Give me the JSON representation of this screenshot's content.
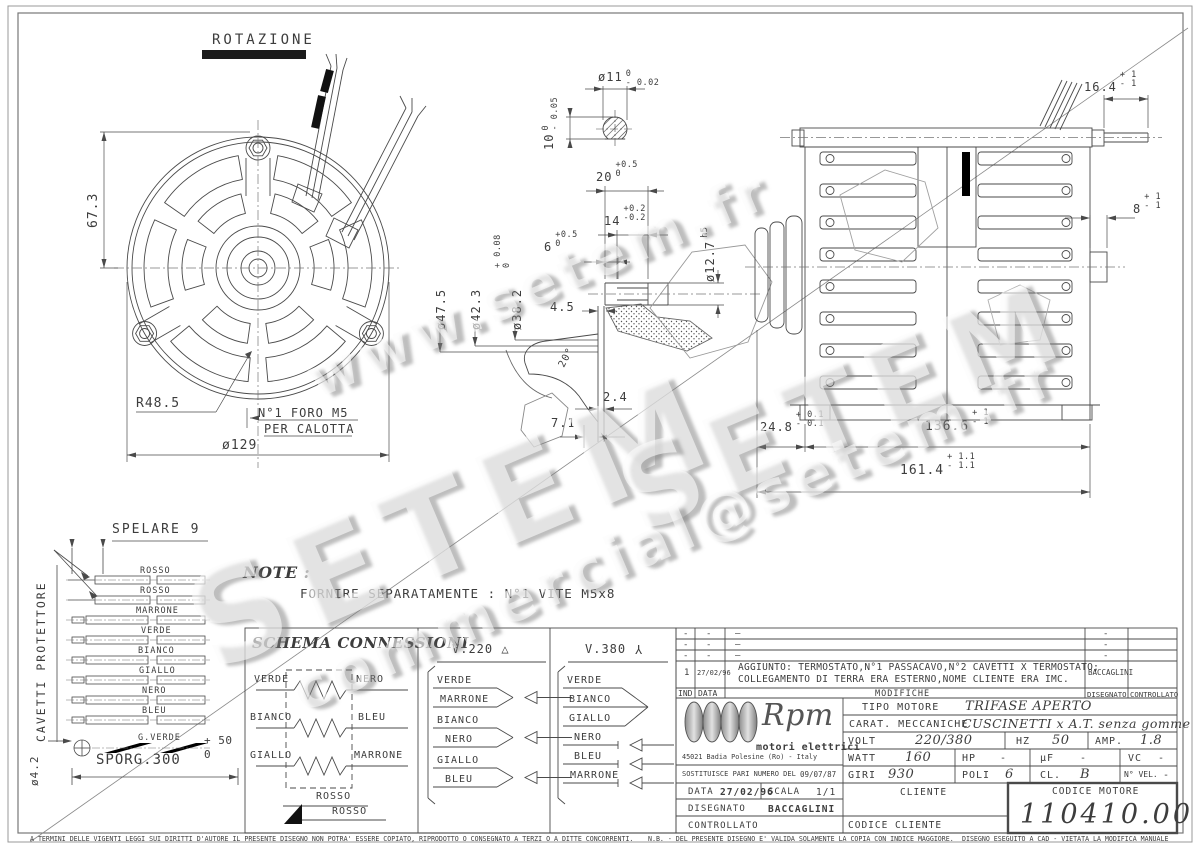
{
  "sheet": {
    "rotazione": "ROTAZIONE",
    "note_title": "NOTE :",
    "note_body": "FORNIRE SEPARATAMENTE : N°1 VITE M5x8",
    "watermark": {
      "w1": "www.setem.fr",
      "w2": "SETEM",
      "w3": "SETEM",
      "w4": "commercial@setem.fr"
    },
    "disclaimer": {
      "left": "A TERMINI DELLE VIGENTI LEGGI SUI DIRITTI D'AUTORE IL PRESENTE DISEGNO NON POTRA' ESSERE COPIATO, RIPRODOTTO O CONSEGNATO A TERZI O A DITTE CONCORRENTI.",
      "nb": "N.B. - DEL PRESENTE DISEGNO E' VALIDA SOLAMENTE LA COPIA CON INDICE MAGGIORE.",
      "right": "DISEGNO ESEGUITO A CAD - VIETATA LA MODIFICA MANUALE"
    }
  },
  "front": {
    "height": "67.3",
    "radius": "R48.5",
    "diameter": "ø129",
    "hole_note1": "N°1 FORO M5",
    "hole_note2": "PER CALOTTA"
  },
  "shaft": {
    "d11": {
      "v": "ø11",
      "up": "0",
      "dn": "- 0.02"
    },
    "d10": {
      "v": "10",
      "up": "0",
      "dn": "- 0.05"
    },
    "d20": {
      "v": "20",
      "up": "+0.5",
      "dn": "0"
    },
    "d14": {
      "v": "14",
      "up": "+0.2",
      "dn": "-0.2"
    },
    "d6": {
      "v": "6",
      "up": "+0.5",
      "dn": "0"
    },
    "d127": {
      "v": "ø12.7",
      "suffix": "h5"
    },
    "d475": "ø47.5",
    "d423": "ø42.3",
    "d382": {
      "v": "ø38.2",
      "up": "+ 0.08",
      "dn": "0"
    },
    "d45": "4.5",
    "d24": "2.4",
    "d71": "7.1",
    "ang": "20°"
  },
  "side": {
    "d164": {
      "v": "16.4",
      "up": "+ 1",
      "dn": "- 1"
    },
    "d8": {
      "v": "8",
      "up": "+ 1",
      "dn": "- 1"
    },
    "d248": {
      "v": "24.8",
      "up": "+ 0.1",
      "dn": "- 0.1"
    },
    "d1366": {
      "v": "136.6",
      "up": "+ 1",
      "dn": "- 1"
    },
    "d1614": {
      "v": "161.4",
      "up": "+ 1.1",
      "dn": "- 1.1"
    }
  },
  "cables": {
    "strip": "SPELARE 9",
    "side_label": "CAVETTI PROTETTORE",
    "diam": "ø4.2",
    "sporg": {
      "v": "SPORG.300",
      "up": "+ 50",
      "dn": "0"
    },
    "wires": [
      "ROSSO",
      "ROSSO",
      "MARRONE",
      "VERDE",
      "BIANCO",
      "GIALLO",
      "NERO",
      "BLEU",
      "G.VERDE"
    ]
  },
  "schema": {
    "title": "SCHEMA CONNESSIONI",
    "res": [
      {
        "l": "VERDE",
        "r": "NERO"
      },
      {
        "l": "BIANCO",
        "r": "BLEU"
      },
      {
        "l": "GIALLO",
        "r": "MARRONE"
      }
    ],
    "rosso1": "ROSSO",
    "rosso2": "ROSSO",
    "v220": {
      "title": "V.220",
      "sym": "△",
      "rows": [
        "VERDE",
        "MARRONE",
        "BIANCO",
        "NERO",
        "GIALLO",
        "BLEU"
      ]
    },
    "v380": {
      "title": "V.380",
      "sym": "Y",
      "rows": [
        "VERDE",
        "BIANCO",
        "GIALLO",
        "NERO",
        "BLEU",
        "MARRONE"
      ]
    }
  },
  "mods": {
    "dash_short": "-",
    "dash_long": "—",
    "row": {
      "ind": "1",
      "date": "27/02/96",
      "line1": "AGGIUNTO: TERMOSTATO,N°1 PASSACAVO,N°2 CAVETTI X TERMOSTATO;",
      "line2": "COLLEGAMENTO DI TERRA ERA ESTERNO,NOME CLIENTE ERA IMC.",
      "dis": "BACCAGLINI"
    },
    "headers": {
      "ind": "IND",
      "date": "DATA",
      "mod": "MODIFICHE",
      "dis": "DISEGNATO",
      "ctrl": "CONTROLLATO"
    }
  },
  "tb": {
    "brand": {
      "name": "Rpm",
      "sub": "motori elettrici",
      "addr": "45021 Badia Polesine (Ro) - Italy"
    },
    "tipo": {
      "label": "TIPO MOTORE",
      "value": "TRIFASE APERTO"
    },
    "carat": {
      "label": "CARAT. MECCANICHE",
      "value": "CUSCINETTI x A.T. senza gomme"
    },
    "volt": {
      "label": "VOLT",
      "value": "220/380"
    },
    "hz": {
      "label": "HZ",
      "value": "50"
    },
    "amp": {
      "label": "AMP.",
      "value": "1.8"
    },
    "watt": {
      "label": "WATT",
      "value": "160"
    },
    "hp": {
      "label": "HP",
      "value": "-"
    },
    "uf": {
      "label": "µF",
      "value": "-"
    },
    "vc": {
      "label": "VC",
      "value": "-"
    },
    "giri": {
      "label": "GIRI",
      "value": "930"
    },
    "poli": {
      "label": "POLI",
      "value": "6"
    },
    "cl": {
      "label": "CL.",
      "value": "B"
    },
    "nvel": {
      "label": "N° VEL.",
      "value": "-"
    },
    "sost": {
      "label": "SOSTITUISCE PARI NUMERO DEL",
      "value": "09/07/87"
    },
    "data": {
      "label": "DATA",
      "value": "27/02/96"
    },
    "scala": {
      "label": "SCALA",
      "value": "1/1"
    },
    "disegnato": {
      "label": "DISEGNATO",
      "value": "BACCAGLINI"
    },
    "controllato": {
      "label": "CONTROLLATO"
    },
    "cliente": "CLIENTE",
    "codice_cliente": "CODICE CLIENTE",
    "codice": {
      "label": "CODICE MOTORE",
      "value": "110410.00"
    }
  }
}
